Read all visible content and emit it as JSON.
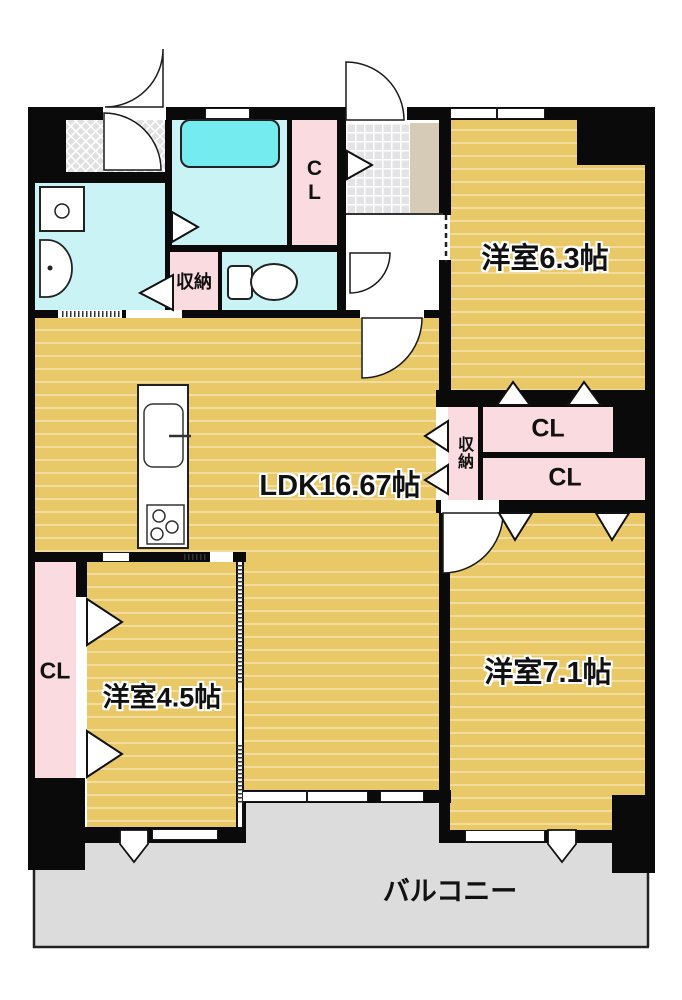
{
  "plan": {
    "rooms": {
      "ldk": {
        "label": "LDK16.67帖"
      },
      "bedroom_6_3": {
        "label": "洋室6.3帖"
      },
      "bedroom_4_5": {
        "label": "洋室4.5帖"
      },
      "bedroom_7_1": {
        "label": "洋室7.1帖"
      },
      "balcony": {
        "label": "バルコニー"
      }
    },
    "storages": {
      "hall_storage": {
        "label": "収納"
      },
      "east_storage": {
        "label": "収納"
      },
      "closet_bath": {
        "label": "CL"
      },
      "closet_west": {
        "label": "CL"
      },
      "closet_east_top": {
        "label": "CL"
      },
      "closet_east_bottom": {
        "label": "CL"
      }
    },
    "colors": {
      "flooring": "#e9c868",
      "stripe": "#f2dd9e",
      "pink": "#fadbdf",
      "cyan": "#c9f3f5",
      "bathtub": "#74ecef",
      "balcony": "#dcdcdc",
      "tile": "#e3e3e5",
      "beige": "#d5cbb7",
      "wall": "#0a0a0a"
    }
  }
}
